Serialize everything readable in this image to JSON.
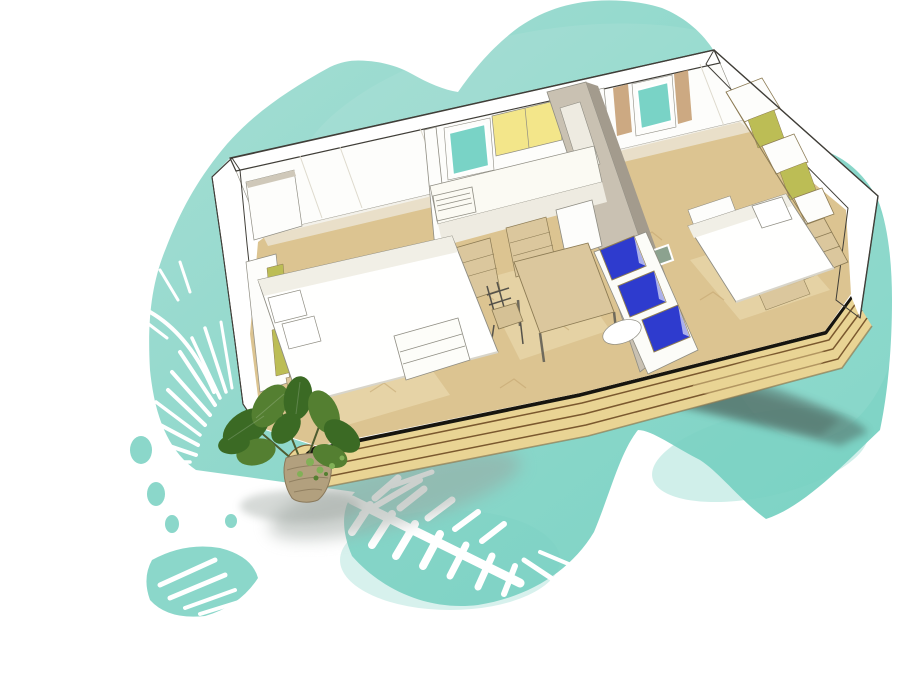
{
  "meta": {
    "description": "Watercolor-style 3D cutaway floor plan illustration of a two-bedroom mobile home with kitchen, dining area, blue sofa cushions, front wooden deck and a potted plant, drawn over a teal organic blob background with white palm-frond silhouettes"
  },
  "colors": {
    "background": "#ffffff",
    "teal_light": "#a7ded4",
    "teal_mid": "#8bd7ca",
    "teal_deep": "#79d2c3",
    "window_glass": "#79d3c6",
    "glass_slot": "#8ca28f",
    "palm_white": "#ffffff",
    "wall_white": "#fdfdfb",
    "wall_shade": "#eeebe1",
    "wall_cut": "#cfc8b9",
    "wall_cut_dark": "#a39b8d",
    "partition": "#c9c1b2",
    "outline": "#403e38",
    "sketch_gray": "#8f8d83",
    "floor_wood": "#dcc491",
    "floor_light": "#eee0b8",
    "floor_line": "#bfa06a",
    "deck_wood": "#e9d494",
    "deck_line": "#7a582e",
    "deck_black": "#17150f",
    "cabinet_yellow": "#f3e68a",
    "panel_olive": "#bcbd55",
    "wood_furniture": "#dbc79d",
    "wood_dark": "#8c7b54",
    "door_tan": "#c39a6c",
    "cushion_blue": "#2e3bce",
    "cushion_dark": "#2330ab",
    "leaf_dark": "#3b6a24",
    "leaf_mid": "#547f31",
    "leaf_light": "#82b057",
    "pot_tan": "#b2a07e",
    "pot_line": "#8a795b",
    "shadow_dark": "#46554f",
    "shadow_soft": "#9aa39d"
  },
  "scene": {
    "background_blob": "teal watercolor blob",
    "palms": "white palm frond silhouettes",
    "building": "mobile home cutaway",
    "rooms": [
      "bedroom left",
      "kitchen",
      "living dining",
      "bedroom right"
    ],
    "deck": "wooden terrace",
    "plant": "potted green plant"
  }
}
